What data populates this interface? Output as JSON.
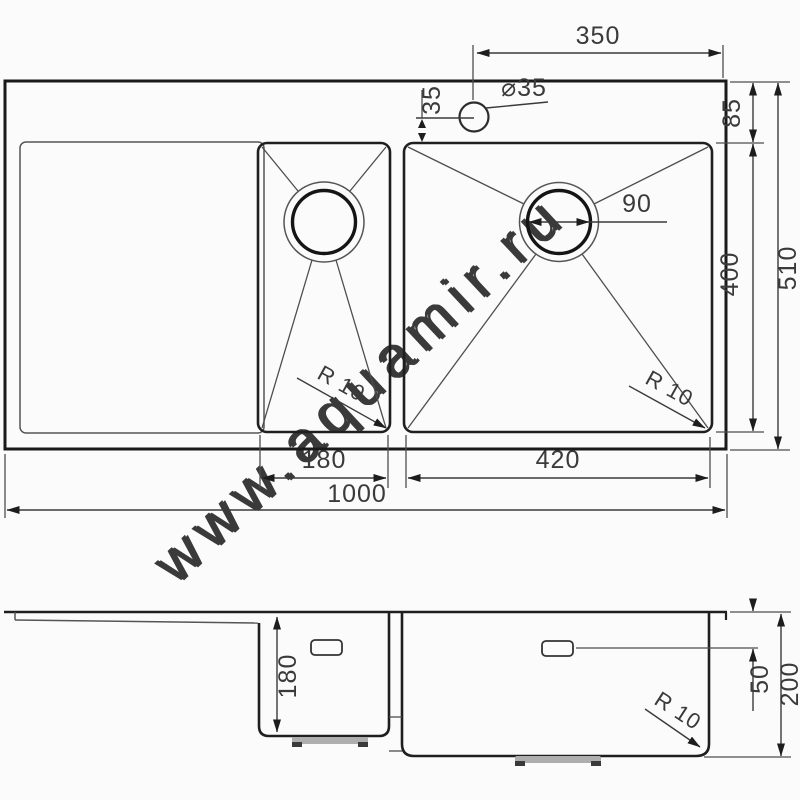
{
  "watermark": "www.aquamir.ru",
  "top_view": {
    "faucet_offset": "350",
    "faucet_hole_diameter": "⌀35",
    "faucet_to_bowl": "35",
    "rim_to_bowl": "85",
    "bowl_length": "400",
    "overall_depth": "510",
    "drain_diameter": "90",
    "small_bowl_radius": "R 10",
    "large_bowl_radius": "R 10",
    "small_bowl_width": "180",
    "large_bowl_width": "420",
    "overall_width": "1000"
  },
  "side_view": {
    "small_bowl_depth": "180",
    "overflow_offset": "50",
    "large_bowl_depth": "200",
    "bottom_radius": "R 10"
  }
}
